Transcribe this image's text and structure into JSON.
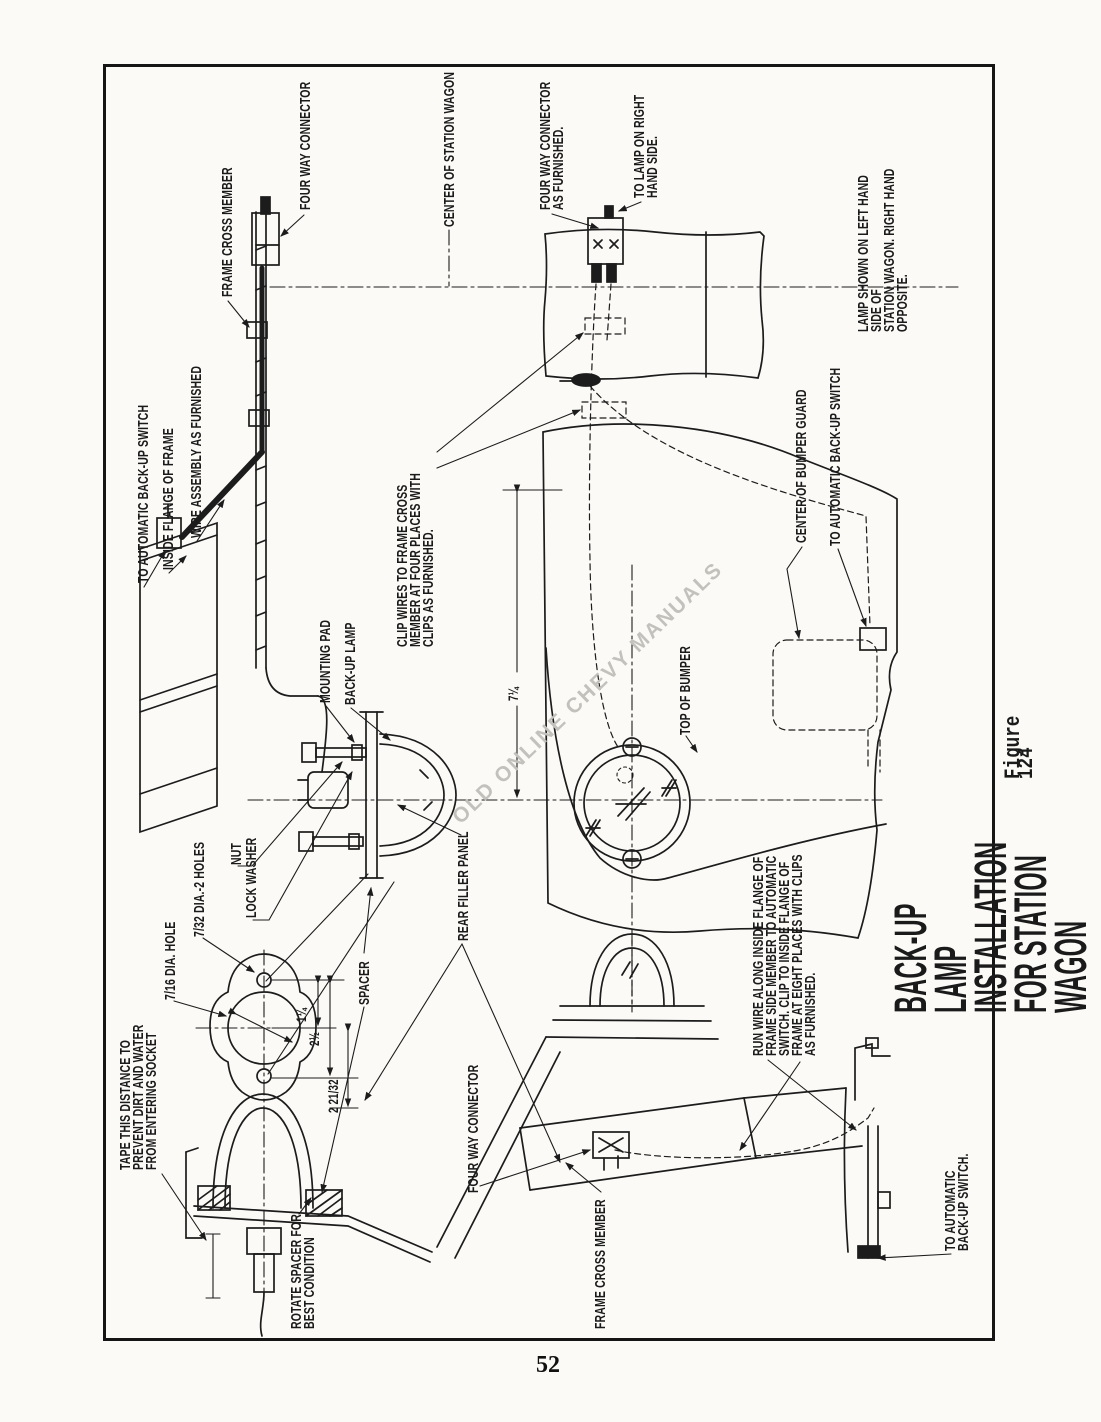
{
  "page": {
    "number": "52"
  },
  "figure": {
    "title": "BACK-UP LAMP INSTALLATION FOR STATION WAGON",
    "caption": "Figure 124"
  },
  "watermark": "OLD ONLINE CHEVY MANUALS",
  "labels": {
    "four_way_connector_top": "FOUR WAY CONNECTOR",
    "frame_cross_member_top": "FRAME CROSS MEMBER",
    "center_of_station_wagon": "CENTER OF STATION WAGON",
    "four_way_connector_as_furnished": "FOUR WAY CONNECTOR\nAS FURNISHED.",
    "to_lamp_on_right": "TO LAMP ON RIGHT\nHAND SIDE.",
    "lamp_shown_note": "LAMP SHOWN ON LEFT HAND SIDE OF\nSTATION WAGON. RIGHT HAND OPPOSITE.",
    "to_automatic_backup_switch_left": "TO AUTOMATIC BACK-UP SWITCH",
    "inside_flange_of_frame": "INSIDE FLANGE OF FRAME",
    "wire_assembly": "WIRE ASSEMBLY AS FURNISHED",
    "clip_wires": "CLIP WIRES TO FRAME CROSS\nMEMBER AT FOUR PLACES WITH\nCLIPS AS FURNISHED.",
    "mounting_pad": "MOUNTING PAD",
    "back_up_lamp": "BACK-UP LAMP",
    "nut": "NUT",
    "lock_washer": "LOCK WASHER",
    "rear_filler_panel": "REAR FILLER PANEL",
    "spacer": "SPACER",
    "dia_2_holes": "7/32 DIA.-2 HOLES",
    "dia_hole": "7/16 DIA. HOLE",
    "tape_note": "TAPE THIS DISTANCE TO\nPREVENT DIRT AND WATER\nFROM ENTERING SOCKET",
    "rotate_spacer": "ROTATE SPACER FOR\nBEST CONDITION",
    "four_way_connector_bottom": "FOUR WAY CONNECTOR",
    "frame_cross_member_bottom": "FRAME CROSS MEMBER",
    "center_of_bumper_guard": "CENTER OF BUMPER GUARD",
    "to_automatic_backup_switch_mid": "TO AUTOMATIC BACK-UP SWITCH",
    "top_of_bumper": "TOP OF BUMPER",
    "run_wire_note": "RUN WIRE ALONG INSIDE FLANGE OF\nFRAME SIDE MEMBER TO AUTOMATIC\nSWITCH. CLIP TO INSIDE FLANGE OF\nFRAME AT EIGHT PLACES WITH CLIPS\nAS FURNISHED.",
    "to_automatic_backup_switch_bottom": "TO AUTOMATIC BACK-UP SWITCH."
  },
  "dimensions": {
    "bumper_to_lamp": "7¼",
    "hole_to_center": "1¼",
    "center_span": "2½",
    "lamp_offset": "2 21/32"
  }
}
